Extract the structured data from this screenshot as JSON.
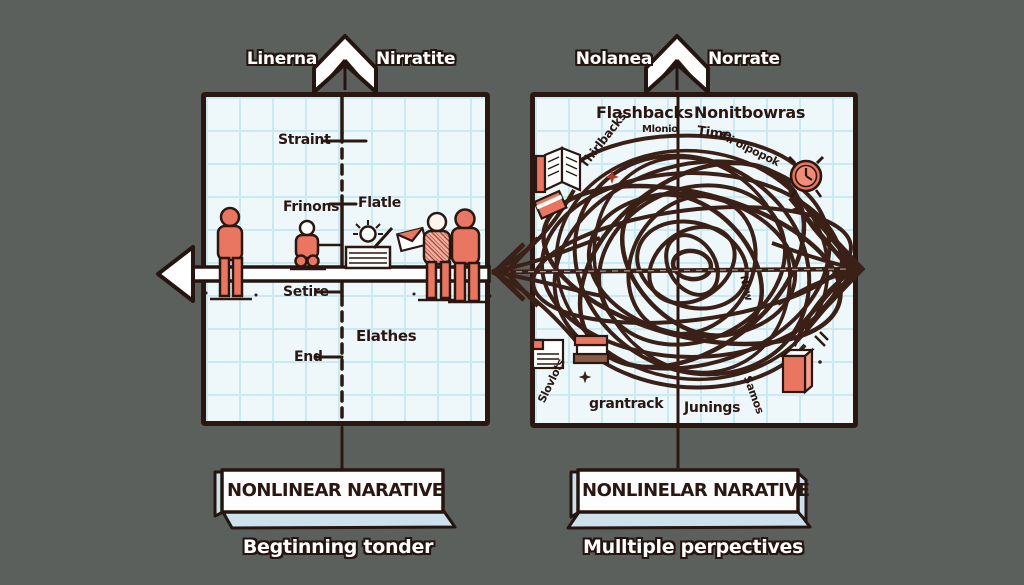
{
  "header": {
    "left_label_1": "Linerna",
    "left_label_2": "Nirratite",
    "right_label_1": "Nolanea",
    "right_label_2": "Norrate"
  },
  "left_panel": {
    "straint": "Straint",
    "frinons": "Frinons",
    "flatle": "Flatle",
    "setire": "Setire",
    "elathes": "Elathes",
    "end": "End"
  },
  "right_panel": {
    "flashbacks": "Flashbacks",
    "nonitbowras": "Nonitbowras",
    "thirlbacks": "Thirlbacks",
    "mlonio": "Mlonio",
    "time": "Time",
    "sli_oipopok": "Sli oipopok",
    "nvw": "Nvw",
    "slovlots": "Slovlots",
    "grantrack": "grantrack",
    "junings": "Junings",
    "samos": "Samos"
  },
  "banners": {
    "left_title": "NONLINEAR NARATIVE",
    "left_caption": "Begtinning tonder",
    "right_title": "NONLINELAR NARATIVE",
    "right_caption": "Mulltiple perpectives"
  },
  "icons": [
    "up-arrow-icon",
    "left-arrow",
    "standing-person-icon",
    "sitting-person-icon",
    "lightbulb-box-icon",
    "envelope-icon",
    "checkered-person-icon",
    "open-book-icon",
    "tilted-book-icon",
    "alarm-clock-icon",
    "document-icon",
    "stacked-books-icon",
    "red-book-icon",
    "sparkle-icon",
    "tangle-scribble"
  ],
  "colors": {
    "background": "#5b605d",
    "paper": "#eef8fb",
    "grid": "#cbe9f2",
    "ink": "#2b1711",
    "accent_salmon": "#e97660",
    "banner_side": "#cde1ed",
    "tangle": "#3a2016"
  }
}
